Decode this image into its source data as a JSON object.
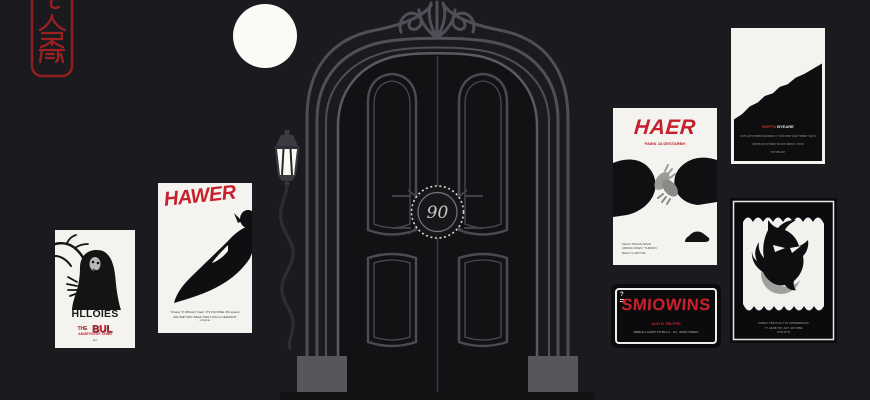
{
  "colors": {
    "background": "#1b1b1f",
    "accent_red": "#c5202c",
    "seal_red": "#9e2121",
    "poster_white": "#f4f3ef",
    "door_line_gray": "#4f4f57"
  },
  "seal": {
    "glyphs": "丂人罙厥",
    "color": "#9e2121"
  },
  "door": {
    "monogram": "90"
  },
  "posters": {
    "ghost": {
      "title": "HLLOIES",
      "the": "THE",
      "bul": "BUL",
      "tagline": "AMGEYSXOF CHNN",
      "footnote": "· ani ·"
    },
    "hawer": {
      "title": "HAWER",
      "credit1": "\"Firawy\" P WRALN \"Haw\" JTF KIN RWE WS avansr",
      "credit2": "WE SMP FDF WELIK KENT WLCH CERWANT",
      "credit3": "a Regnav"
    },
    "haer": {
      "title": "HAER",
      "subtitle": "FAWN JA DESTARBH",
      "credit1": "Marah TWAAS ARVAI",
      "credit2": "ARWAK ASWLY THIRRIN",
      "credit3": "BHULYL ARTTIW"
    },
    "mountain": {
      "title_red": "ROPTS",
      "title_white": "BYEARE",
      "credit1": "WYB LW TRYBRW WR BWRLYY TR WYRBY LWR T BRWY WLYR",
      "credit2": "WRYB LWYR TRWB YR WYR BRWYL TRYW",
      "credit3": "TWYRB LWY"
    },
    "smlowins": {
      "corner_mark": "?",
      "title": "SMIOWINS",
      "subtitle": "ACN B TBLPPE",
      "credit": "WRBLE A LAWST TIN BLYLL · LIA · SPWA TRWNH"
    },
    "owl": {
      "credit1": "WRBAY TBRYICW TYR KWWRBRWCR",
      "credit2": "TY LWRB TRY ARY LWYRIBR",
      "credit3": "WYB RYR"
    }
  }
}
